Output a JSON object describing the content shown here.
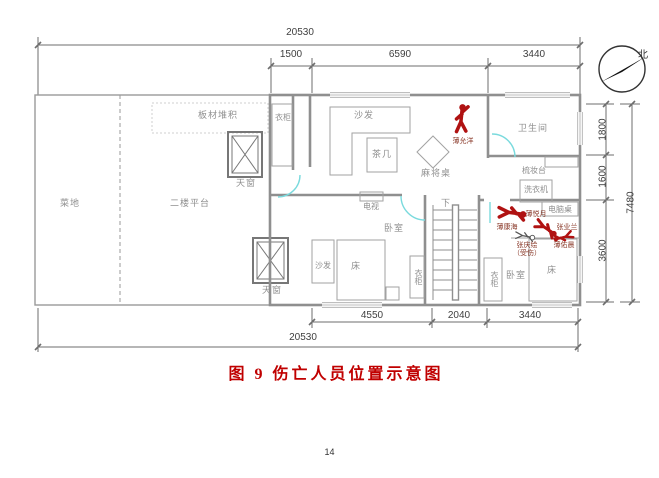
{
  "caption": "图 9  伤亡人员位置示意图",
  "page_number": "14",
  "compass": {
    "north_label": "北"
  },
  "dims": {
    "top_total": "20530",
    "top_seg_1": "1500",
    "top_seg_2": "6590",
    "top_seg_3": "3440",
    "right_seg_1": "1800",
    "right_seg_2": "1600",
    "right_seg_3": "3600",
    "right_total": "7480",
    "bottom_seg_1": "4550",
    "bottom_seg_2": "2040",
    "bottom_seg_3": "3440",
    "bottom_total": "20530"
  },
  "labels": {
    "vegetable_plot": "菜地",
    "platform": "二楼平台",
    "board_pile": "板材堆积",
    "skylight_top": "天窗",
    "skylight_bottom": "天窗",
    "wardrobe_entry": "衣柜",
    "sofa_living": "沙发",
    "tea_table": "茶几",
    "mahjong_table": "麻将桌",
    "bathroom": "卫生间",
    "dressing_table": "梳妆台",
    "washing_machine": "洗衣机",
    "tv": "电视",
    "bedroom_left": "卧室",
    "bed_left": "床",
    "sofa_bedroom": "沙发",
    "wardrobe_left": "衣柜",
    "stairs_down": "下",
    "computer_desk": "电脑桌",
    "wardrobe_right": "衣柜",
    "bedroom_right": "卧室",
    "bed_right": "床"
  },
  "casualties": {
    "standing": {
      "name": "薄允洋"
    },
    "lying_right": {
      "name": "薄悦月"
    },
    "lying_below": {
      "name": "薄康海"
    },
    "middle": {
      "name": "张业兰"
    },
    "right": {
      "name": "薄佑晨"
    },
    "injured": {
      "name": "张庆绘",
      "status": "（受伤）"
    }
  },
  "colors": {
    "casualty_red": "#b01212",
    "door_cyan": "#7adadd",
    "caption_red": "#c00000",
    "line_gray": "#8f8f8f"
  }
}
